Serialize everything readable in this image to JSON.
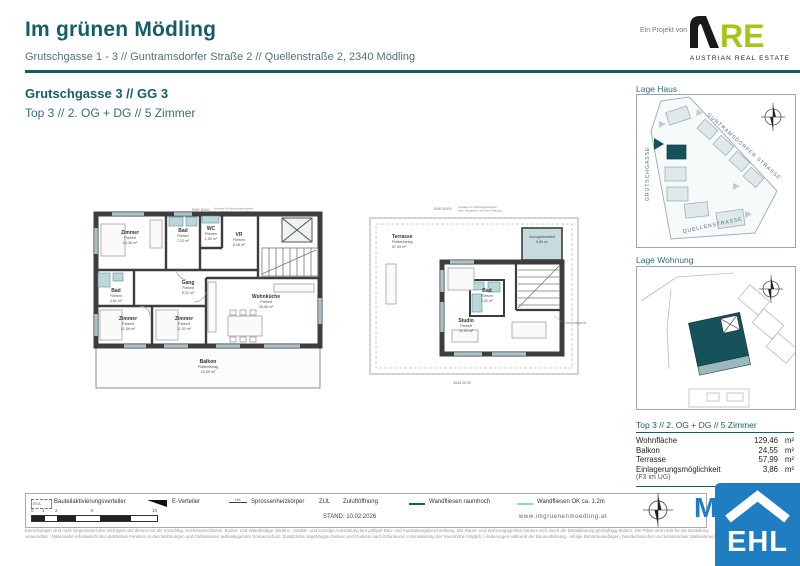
{
  "header": {
    "title": "Im grünen Mödling",
    "subtitle": "Grutschgasse 1 - 3 // Guntramsdorfer Straße 2 // Quellenstraße 2, 2340 Mödling",
    "project_label": "Ein Projekt von",
    "are": {
      "re": "RE",
      "tagline": "AUSTRIAN REAL ESTATE"
    }
  },
  "section": {
    "building": "Grutschgasse 3 // GG 3",
    "unit": "Top 3 // 2. OG + DG // 5 Zimmer"
  },
  "plans": {
    "og": {
      "annotation_rar": "RAR Ø100",
      "annotation_note1": "Auslass für Wartungsarbeiten",
      "annotation_note2": "über Steigleiter mit fixer Führung",
      "rooms": [
        {
          "name": "Zimmer",
          "floor": "Parkett",
          "area": "15,38 m²"
        },
        {
          "name": "Bad",
          "floor": "Fliesen",
          "area": "7,23 m²"
        },
        {
          "name": "WC",
          "floor": "Fliesen",
          "area": "1,50 m²"
        },
        {
          "name": "VR",
          "floor": "Fliesen",
          "area": "6,38 m²"
        },
        {
          "name": "Bad",
          "floor": "Fliesen",
          "area": "4,81 m²"
        },
        {
          "name": "Gang",
          "floor": "Parkett",
          "area": "9,32 m²"
        },
        {
          "name": "Zimmer",
          "floor": "Parkett",
          "area": "11,88 m²"
        },
        {
          "name": "Zimmer",
          "floor": "Parkett",
          "area": "11,52 m²"
        },
        {
          "name": "Wohnküche",
          "floor": "Parkett",
          "area": "28,08 m²"
        },
        {
          "name": "Balkon",
          "floor": "Plattenbelag",
          "area": "24,55 m²"
        }
      ]
    },
    "dg": {
      "annotation_rar": "RAR Ø100",
      "annotation_note1": "Auslass für Wartungsarbeiten",
      "annotation_note2": "über Steigleiter mit fixer Führung",
      "annotation_dim": "5645 Ø100",
      "annotation_unit": "Kompaktgerät",
      "rooms": [
        {
          "name": "Terrasse",
          "floor": "Plattenbelag",
          "area": "57,99 m²"
        },
        {
          "name": "Studio",
          "floor": "Parkett",
          "area": "32,93 m²"
        },
        {
          "name": "Bad",
          "floor": "Fliesen",
          "area": "5,32 m²"
        },
        {
          "name": "Aufzugsüberfahrt",
          "floor": "",
          "area": "5,56 m²"
        }
      ]
    }
  },
  "side": {
    "lage_haus": {
      "label": "Lage Haus",
      "streets": [
        "GUNTRAMSDORFER STRASSE",
        "GRUTSCHGASSE",
        "QUELLENSTRASSE"
      ]
    },
    "lage_wohnung": {
      "label": "Lage Wohnung"
    },
    "table": {
      "header": "Top 3 // 2. OG + DG // 5 Zimmer",
      "rows": [
        {
          "label": "Wohnfläche",
          "value": "129,46",
          "unit": "m²"
        },
        {
          "label": "Balkon",
          "value": "24,55",
          "unit": "m²"
        },
        {
          "label": "Terrasse",
          "value": "57,99",
          "unit": "m²"
        },
        {
          "label": "Einlagerungsmöglichkeit",
          "value": "3,86",
          "unit": "m²"
        }
      ],
      "note": "(F3 im UG)"
    }
  },
  "footer": {
    "legend": {
      "bta_abbr": "BTA",
      "bta": "Bauteilaktivierungsverteiler",
      "ev": "E-Verteiler",
      "hk_abbr": "HK",
      "hk": "Sprossenheizkörper",
      "zul_abbr": "ZUL",
      "zul": "Zuluftöffnung",
      "wf_high": "Wandfliesen raumhoch",
      "wf_low": "Wandfliesen OK ca. 1.2m"
    },
    "scale_ticks": [
      "0",
      "1",
      "2",
      "5",
      "10"
    ],
    "stand": "STAND: 10.02.2026",
    "website": "www.imgruenenmoedling.at",
    "disclaimer1": "Einrichtungen sind nicht Gegenstand des Vertrages und dienen nur als Vorschlag. Küchenanschlüsse, Boden- und Wandbeläge, Elektro-, Sanitär- und sonstige Ausstattung laut gültiger Bau- und Ausstattungsbeschreibung. Die Raum- und Wohnungsgrößen können sich durch die Detailplanung geringfügig ändern. Die Pläne sind nicht für die Bestellung",
    "disclaimer2": "verwendbar - Naturmaße erforderlich! Bei sämtlichen Fenstern in den Wohnungen und Ordinationen außenliegender Sonnenschutz. Zusätzliche abgehängte Decken und Podeste nach Erfordernis. (Abminderung der Raumhöhe möglich.) Änderungen während der Bauausführung - infolge Behördenauflagen, haustechnischer und konstruktiver Maßnahmen - vorbehalten."
  },
  "logos": {
    "ehl": "EHL",
    "m_watermark": "M"
  },
  "colors": {
    "teal": "#155E66",
    "are_green": "#A3C617",
    "ehl_blue": "#1F7DC2",
    "plan_teal": "#BCD7DA"
  }
}
